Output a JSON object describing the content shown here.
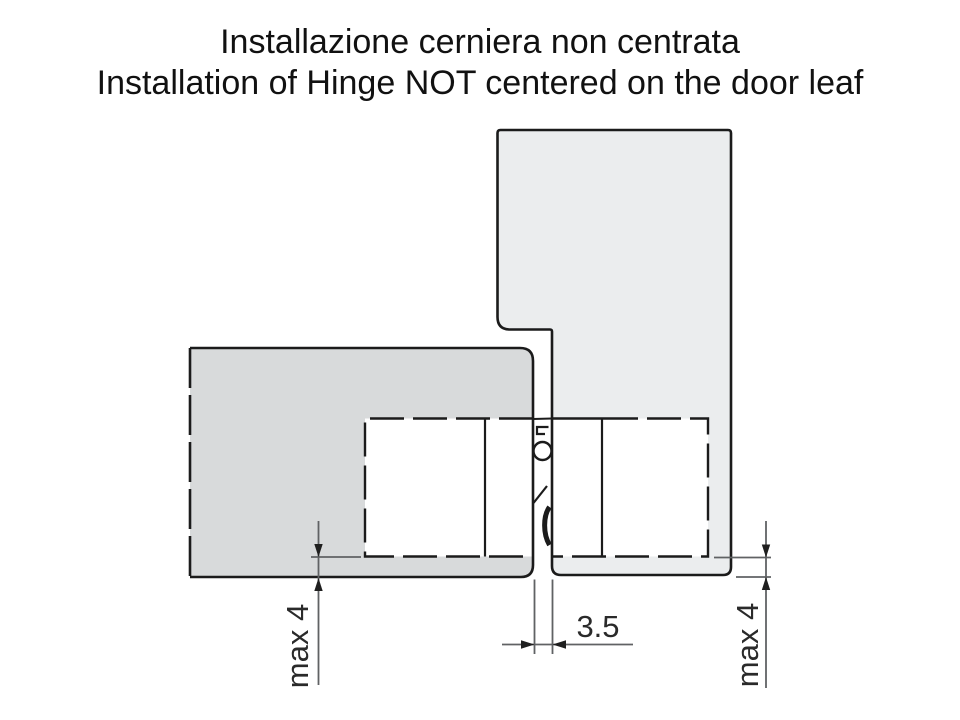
{
  "title": {
    "line1": "Installazione cerniera non centrata",
    "line2": "Installation of Hinge NOT centered on the door leaf"
  },
  "diagram": {
    "labels": {
      "left_offset": "max 4",
      "reveal_gap": "3.5",
      "right_offset": "max 4"
    },
    "colors": {
      "background": "#ffffff",
      "door_leaf_fill": "#d8dadb",
      "frame_fill": "#ebedee",
      "outline": "#1b1b1b",
      "dimension_line": "#606264",
      "text": "#111111"
    }
  }
}
